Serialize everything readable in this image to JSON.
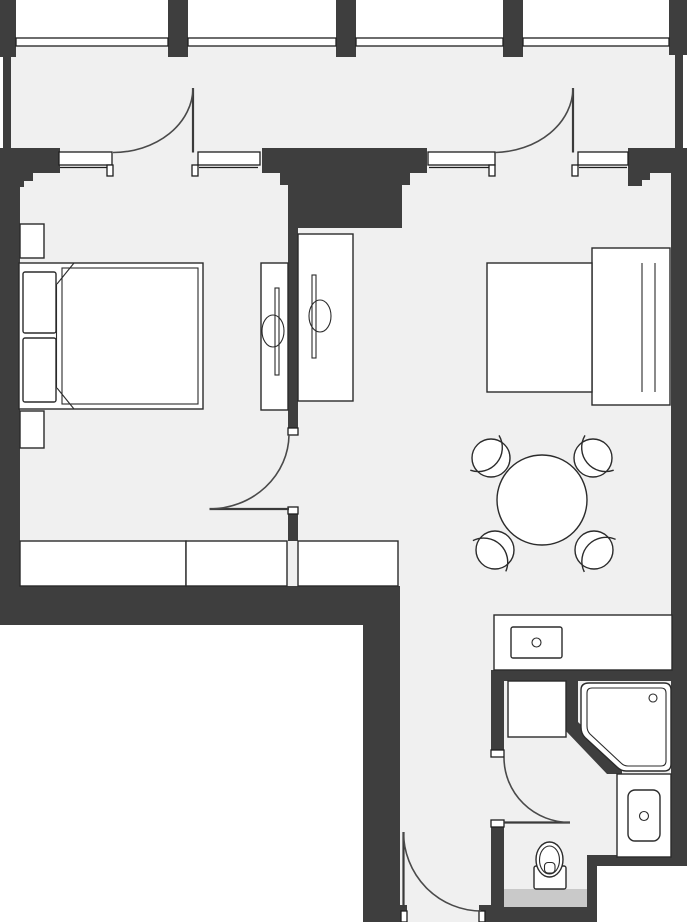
{
  "plan": {
    "kind": "apartment-floor-plan",
    "has_text": false
  },
  "colors": {
    "wall": "#3e3e3e",
    "floor": "#f0f0f0",
    "outside": "#ffffff",
    "fixture": "#ffffff",
    "line": "#2b2b2b",
    "door_line": "#4a4a4a",
    "mat": "#c9c9c9"
  },
  "fixtures": [
    "pillar",
    "balcony",
    "balcony-railing",
    "window",
    "balcony-door",
    "double-bed",
    "pillow",
    "nightstand",
    "tv-unit",
    "wardrobe",
    "interior-door",
    "single-bed",
    "dining-table",
    "chair",
    "kitchen-counter",
    "kitchen-sink",
    "washing-machine",
    "corner-shower",
    "washbasin-vanity",
    "toilet",
    "bath-mat",
    "entrance-door"
  ],
  "counts": {
    "pillars": 5,
    "windows": 4,
    "doors": 5,
    "chairs": 4,
    "wardrobe_sections": 3
  }
}
